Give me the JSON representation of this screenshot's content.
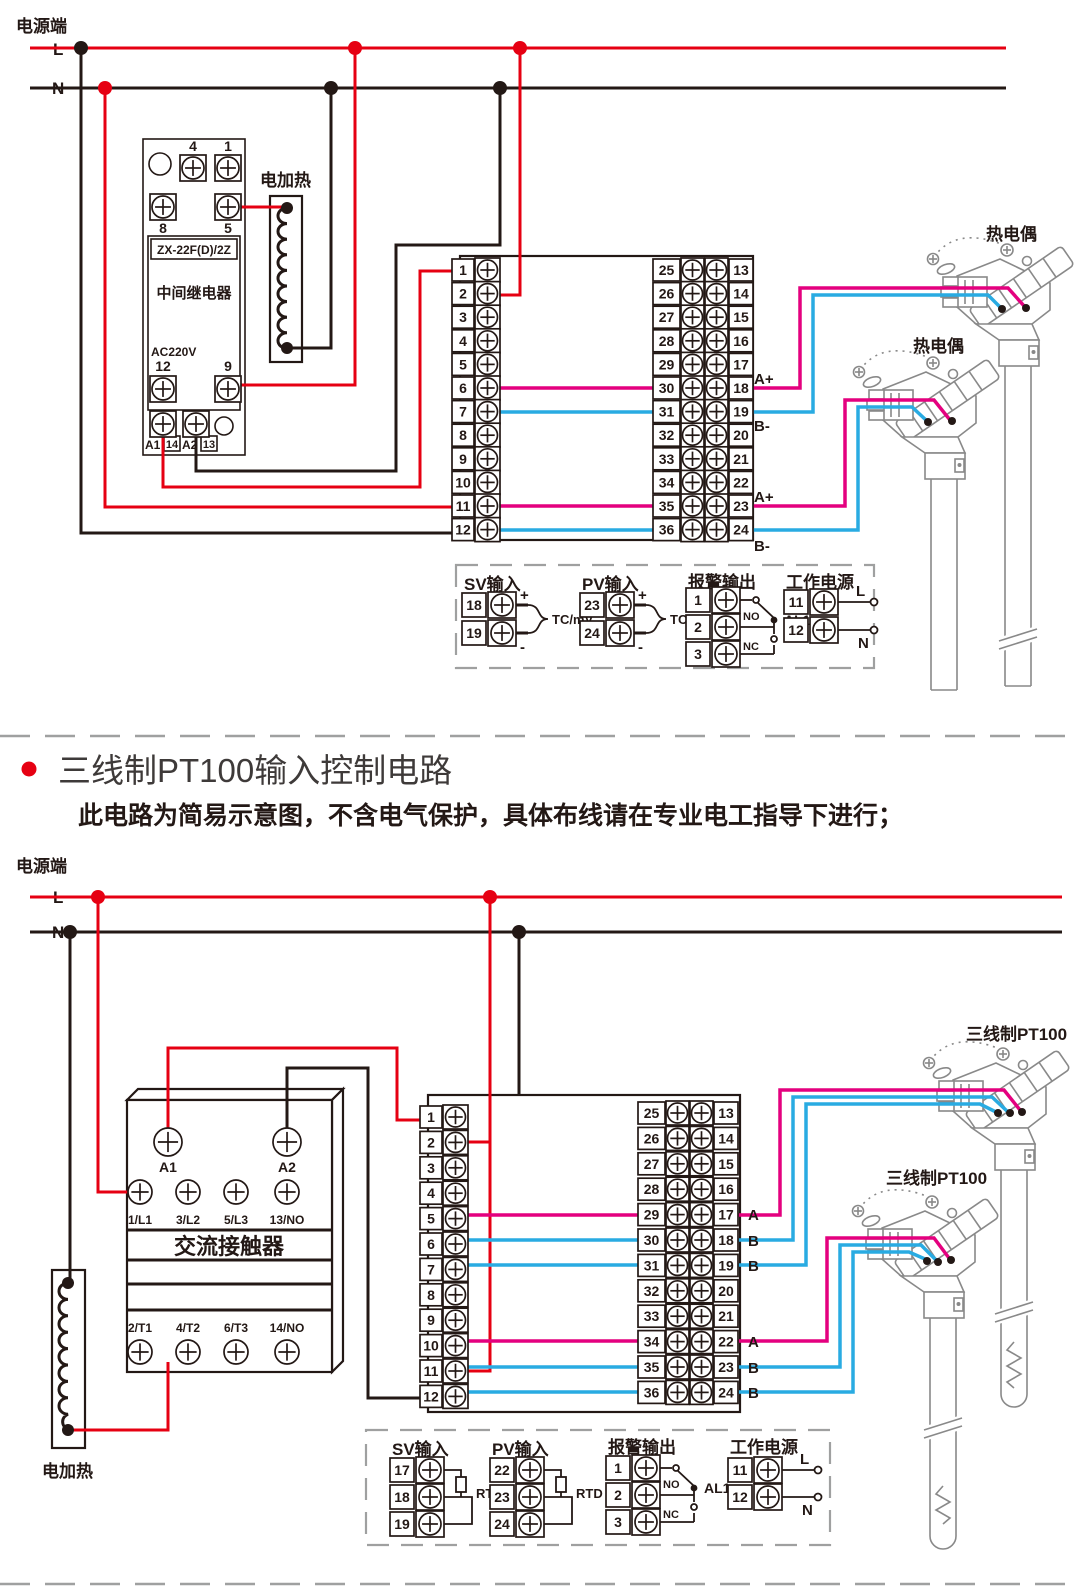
{
  "colors": {
    "red": "#e60012",
    "black": "#231815",
    "magenta": "#e4007f",
    "blue": "#29abe2",
    "sensor_gray": "#898989",
    "dash_gray": "#9fa0a0"
  },
  "top_diagram": {
    "power": {
      "label": "电源端",
      "l": "L",
      "n": "N"
    },
    "heater_label": "电加热",
    "relay": {
      "model": "ZX-22F(D)/2Z",
      "name": "中间继电器",
      "voltage": "AC220V",
      "t_top": [
        "4",
        "1"
      ],
      "t_mid": [
        "8",
        "5"
      ],
      "t_low": [
        "12",
        "9"
      ],
      "t_coil": [
        "A1",
        "14",
        "A2",
        "13"
      ]
    },
    "controller": {
      "left": [
        "1",
        "2",
        "3",
        "4",
        "5",
        "6",
        "7",
        "8",
        "9",
        "10",
        "11",
        "12"
      ],
      "right_outer": [
        "25",
        "26",
        "27",
        "28",
        "29",
        "30",
        "31",
        "32",
        "33",
        "34",
        "35",
        "36"
      ],
      "right_inner": [
        "13",
        "14",
        "15",
        "16",
        "17",
        "18",
        "19",
        "20",
        "21",
        "22",
        "23",
        "24"
      ]
    },
    "sensors": [
      {
        "label": "热电偶"
      },
      {
        "label": "热电偶"
      }
    ],
    "wire_labels": [
      "A+",
      "B-",
      "A+",
      "B-"
    ],
    "detail": {
      "sv": {
        "title": "SV输入",
        "terminals": [
          "18",
          "19"
        ],
        "plus": "+",
        "minus": "-",
        "signal": "TC/mV"
      },
      "pv": {
        "title": "PV输入",
        "terminals": [
          "23",
          "24"
        ],
        "plus": "+",
        "minus": "-",
        "signal": "TC/mV"
      },
      "alarm": {
        "title": "报警输出",
        "terminals": [
          "1",
          "2",
          "3"
        ],
        "no": "NO",
        "nc": "NC",
        "name": "AL1"
      },
      "power": {
        "title": "工作电源",
        "terminals": [
          "11",
          "12"
        ],
        "l": "L",
        "n": "N"
      }
    }
  },
  "section": {
    "title": "三线制PT100输入控制电路",
    "subtitle": "此电路为简易示意图，不含电气保护，具体布线请在专业电工指导下进行；"
  },
  "bottom_diagram": {
    "power": {
      "label": "电源端",
      "l": "L",
      "n": "N"
    },
    "heater_label": "电加热",
    "contactor": {
      "coil": [
        "A1",
        "A2"
      ],
      "top_row": [
        "1/L1",
        "3/L2",
        "5/L3",
        "13/NO"
      ],
      "name": "交流接触器",
      "bottom_row": [
        "2/T1",
        "4/T2",
        "6/T3",
        "14/NO"
      ]
    },
    "controller": {
      "left": [
        "1",
        "2",
        "3",
        "4",
        "5",
        "6",
        "7",
        "8",
        "9",
        "10",
        "11",
        "12"
      ],
      "right_outer": [
        "25",
        "26",
        "27",
        "28",
        "29",
        "30",
        "31",
        "32",
        "33",
        "34",
        "35",
        "36"
      ],
      "right_inner": [
        "13",
        "14",
        "15",
        "16",
        "17",
        "18",
        "19",
        "20",
        "21",
        "22",
        "23",
        "24"
      ]
    },
    "sensors": [
      {
        "label": "三线制PT100"
      },
      {
        "label": "三线制PT100"
      }
    ],
    "wire_labels": [
      "A",
      "B",
      "B",
      "A",
      "B",
      "B"
    ],
    "detail": {
      "sv": {
        "title": "SV输入",
        "terminals": [
          "17",
          "18",
          "19"
        ],
        "signal": "RTD"
      },
      "pv": {
        "title": "PV输入",
        "terminals": [
          "22",
          "23",
          "24"
        ],
        "signal": "RTD"
      },
      "alarm": {
        "title": "报警输出",
        "terminals": [
          "1",
          "2",
          "3"
        ],
        "no": "NO",
        "nc": "NC",
        "name": "AL1"
      },
      "power": {
        "title": "工作电源",
        "terminals": [
          "11",
          "12"
        ],
        "l": "L",
        "n": "N"
      }
    }
  }
}
